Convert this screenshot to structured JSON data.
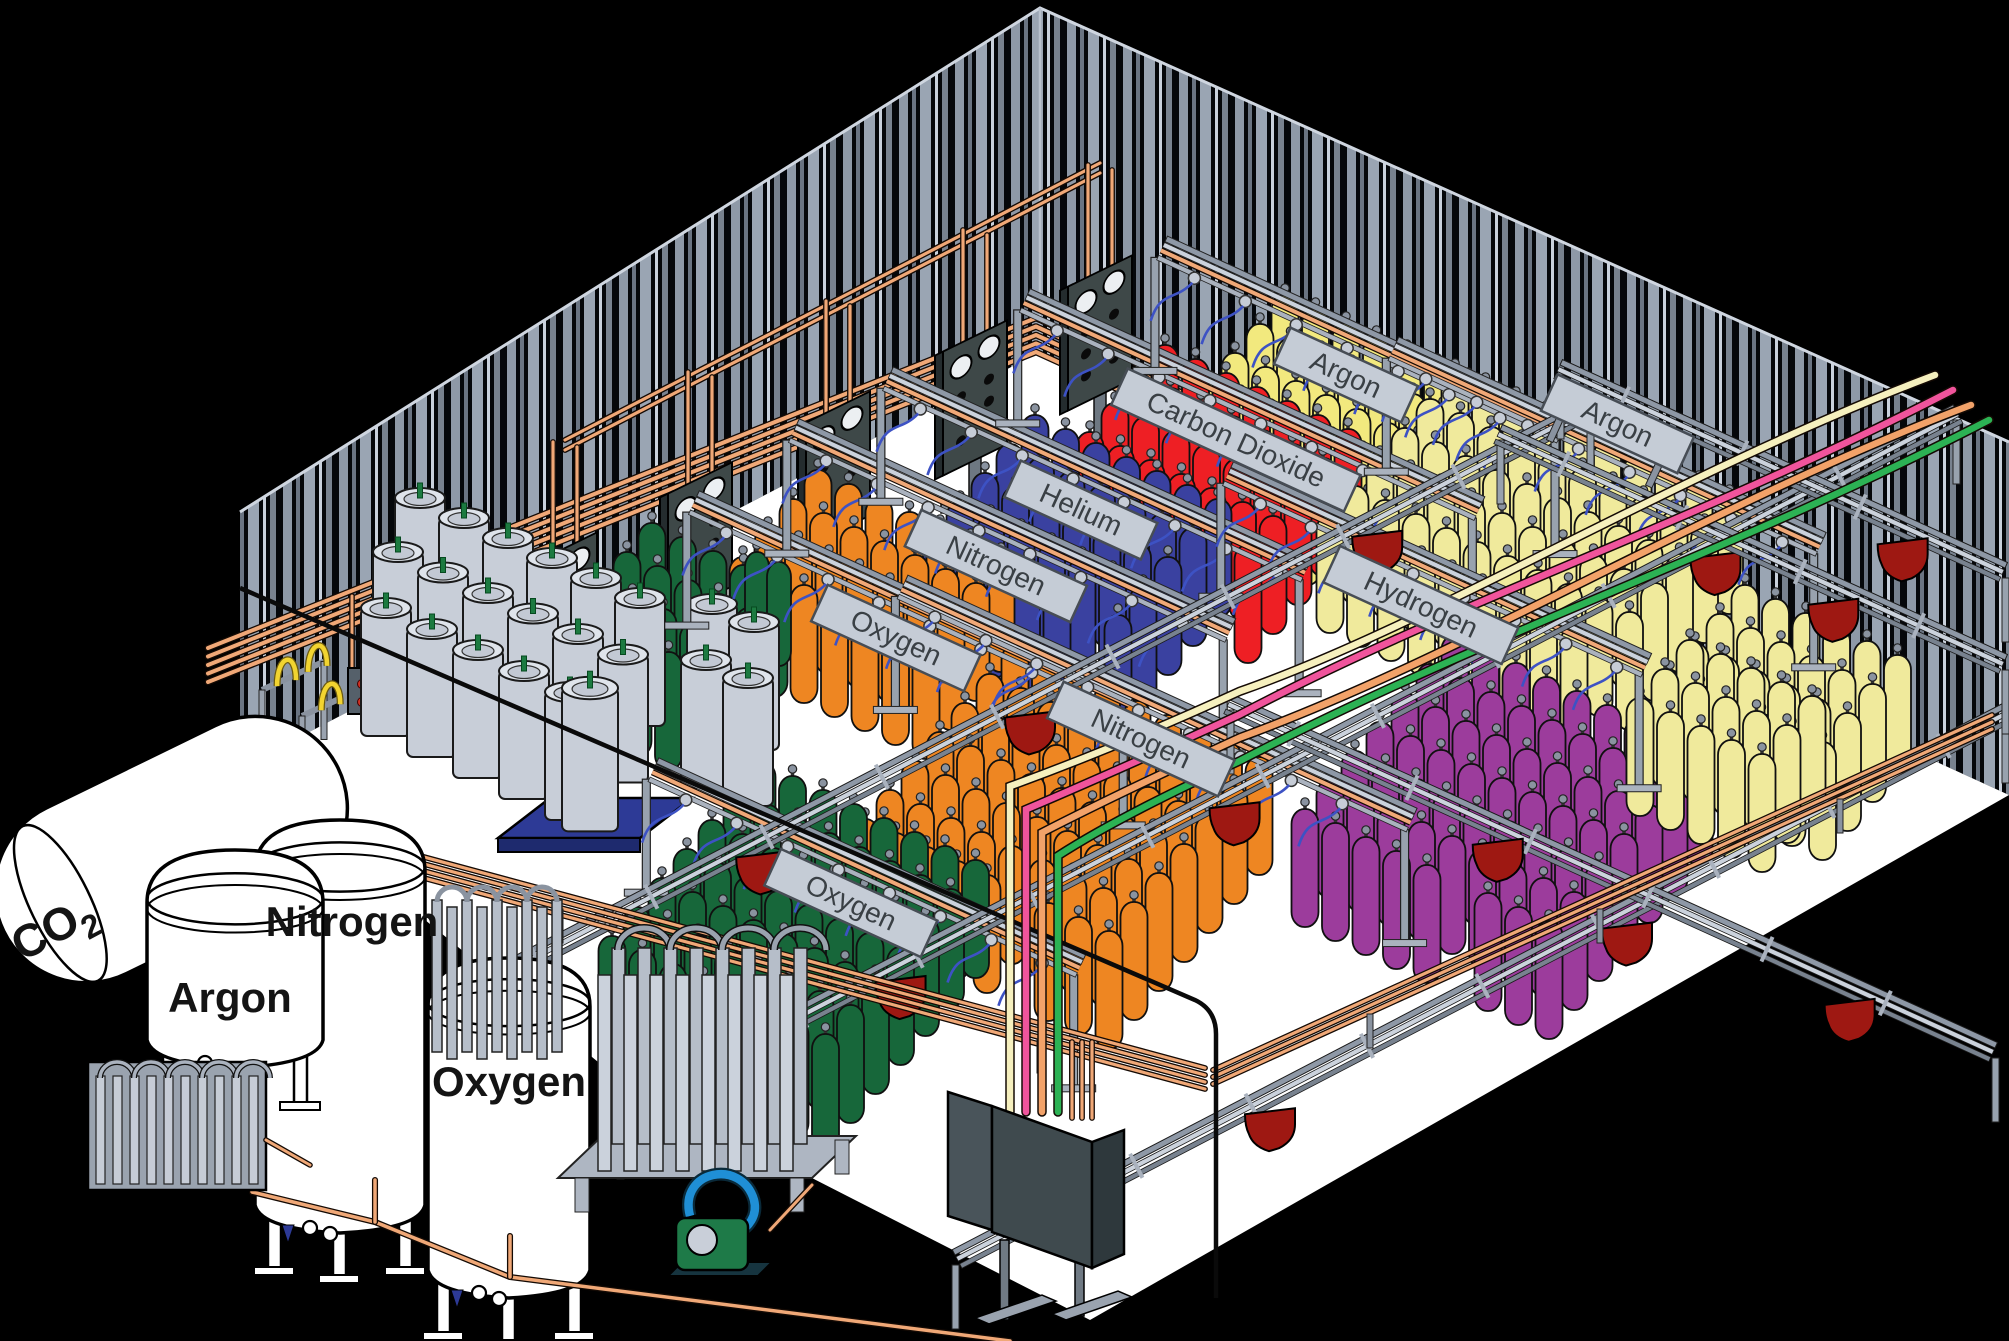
{
  "bulk_storage": {
    "co2_tank": {
      "label_main": "CO",
      "label_sub": "2"
    },
    "argon_tank": {
      "label": "Argon"
    },
    "nitrogen_tank": {
      "label": "Nitrogen"
    },
    "oxygen_tank": {
      "label": "Oxygen"
    }
  },
  "fill_stations": {
    "back": [
      {
        "label": "Oxygen",
        "cylinder_color": "#EE8622"
      },
      {
        "label": "Nitrogen",
        "cylinder_color": "#3A41A0"
      },
      {
        "label": "Helium",
        "cylinder_color": "#EE1F24"
      },
      {
        "label": "Carbon Dioxide",
        "cylinder_color": "#F2E97E"
      },
      {
        "label": "Argon",
        "cylinder_color": "#F0EA9C"
      }
    ],
    "right": [
      {
        "label": "Hydrogen",
        "cylinder_color": "#9C3C9C"
      },
      {
        "label": "Argon",
        "cylinder_color": "#F0EA9C"
      }
    ],
    "front": [
      {
        "label": "Nitrogen",
        "cylinder_color": "#3A41A0"
      },
      {
        "label": "Oxygen",
        "cylinder_color": "#17673A"
      }
    ]
  },
  "colors": {
    "background": "#000000",
    "floor": "#FFFFFF",
    "wall_stripe": "#97A1AE",
    "copper_pipe": "#F0A877",
    "rail_gray": "#C5CCD6",
    "panel_dark": "#3E4848",
    "trolley_red": "#9E1812",
    "hose_blue": "#3D52C4",
    "dewar_gray": "#C8CED8",
    "pallet_blue": "#2D3A96",
    "supply_line_cream": "#F6F0BE",
    "supply_line_pink": "#F0549C",
    "supply_line_orange": "#F2A269",
    "supply_line_green": "#2CB254"
  }
}
